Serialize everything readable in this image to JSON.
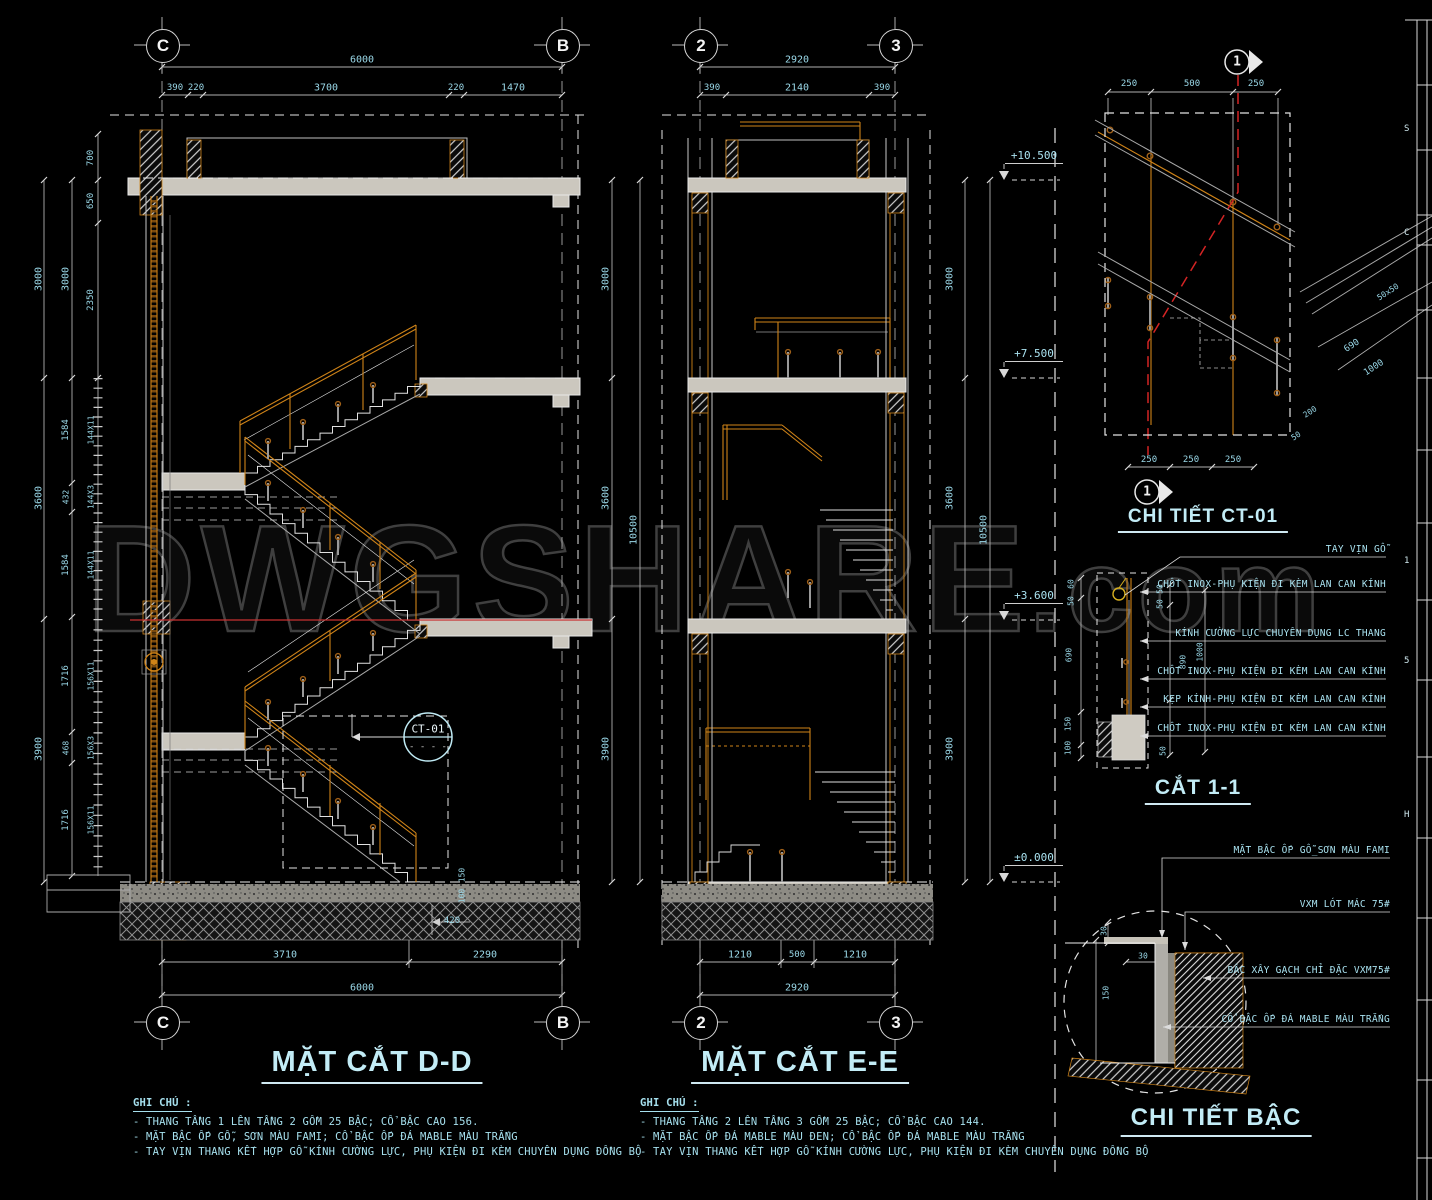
{
  "watermark": {
    "main": "DWGSHARE",
    "suffix": ".com"
  },
  "grid_bubbles": [
    "C",
    "B",
    "2",
    "3",
    "C",
    "B",
    "2",
    "3"
  ],
  "sections": {
    "dd": {
      "title": "MẶT CẮT D-D",
      "notes_heading": "GHI CHÚ :",
      "notes": [
        "- THANG TẦNG 1 LÊN TẦNG 2 GỒM 25 BẬC; CỔ BẬC CAO 156.",
        "- MẶT BẬC ỐP GỖ, SƠN MÀU FAMI; CỔ BẬC ỐP ĐÁ MABLE MÀU TRẮNG",
        "- TAY VỊN THANG KẾT HỢP GỖ KÍNH CƯỜNG LỰC, PHỤ KIỆN ĐI KÈM CHUYÊN DỤNG ĐỒNG BỘ"
      ]
    },
    "ee": {
      "title": "MẶT CẮT E-E",
      "notes_heading": "GHI CHÚ :",
      "notes": [
        "- THANG TẦNG 2 LÊN TẦNG 3 GỒM 25 BẬC; CỔ BẬC CAO 144.",
        "- MẶT BẬC ỐP ĐÁ MABLE MÀU ĐEN; CỔ BẬC ỐP ĐÁ MABLE MÀU TRẮNG",
        "- TAY VỊN THANG KẾT HỢP GỖ KÍNH CƯỜNG LỰC, PHỤ KIỆN ĐI KÈM CHUYÊN DỤNG ĐỒNG BỘ"
      ]
    },
    "ct01": {
      "title": "CHI TIẾT CT-01",
      "marker": "1"
    },
    "cat11": {
      "title": "CẮT 1-1",
      "labels": [
        "TAY VỊN GỖ",
        "CHỐT INOX-PHỤ KIỆN ĐI KÈM LAN CAN KÍNH",
        "KÍNH CƯỜNG LỰC CHUYÊN DỤNG LC THANG",
        "CHỐT INOX-PHỤ KIỆN ĐI KÈM LAN CAN KÍNH",
        "KẸP KÍNH-PHỤ KIỆN ĐI KÈM LAN CAN KÍNH",
        "CHỐT INOX-PHỤ KIỆN ĐI KÈM LAN CAN KÍNH"
      ]
    },
    "bac": {
      "title": "CHI TIẾT BẬC",
      "labels": [
        "MẶT BẬC ỐP GỖ_SƠN MÀU FAMI",
        "VXM LÓT MÁC 75#",
        "BẬC XÂY GẠCH CHỈ ĐẶC VXM75#",
        "CỔ BẬC ỐP ĐÁ MABLE MÀU TRẮNG"
      ]
    }
  },
  "callout": {
    "label": "CT-01",
    "dash": "- - - -"
  },
  "elevations": [
    "+10.500",
    "+7.500",
    "+3.600",
    "±0.000"
  ],
  "colors": {
    "dim_text": "#9ad8e8",
    "wood": "#cf8318",
    "section_red": "#d42424",
    "line": "#c8c8c8"
  },
  "titleblock_fragments": [
    {
      "t": "S",
      "y": 124
    },
    {
      "t": "C",
      "y": 228
    },
    {
      "t": "1",
      "y": 556
    },
    {
      "t": "5",
      "y": 656
    },
    {
      "t": "H",
      "y": 810
    }
  ],
  "dim_labels": [
    {
      "t": "6000",
      "x": 362,
      "y": 60,
      "r": 0
    },
    {
      "t": "390",
      "x": 175,
      "y": 88,
      "r": 0,
      "s": 9
    },
    {
      "t": "220",
      "x": 196,
      "y": 88,
      "r": 0,
      "s": 9
    },
    {
      "t": "3700",
      "x": 326,
      "y": 88,
      "r": 0
    },
    {
      "t": "220",
      "x": 456,
      "y": 88,
      "r": 0,
      "s": 9
    },
    {
      "t": "1470",
      "x": 513,
      "y": 88,
      "r": 0
    },
    {
      "t": "700",
      "x": 91,
      "y": 158,
      "r": -90,
      "s": 9
    },
    {
      "t": "650",
      "x": 91,
      "y": 201,
      "r": -90,
      "s": 9
    },
    {
      "t": "3000",
      "x": 39,
      "y": 279,
      "r": -90
    },
    {
      "t": "3000",
      "x": 66,
      "y": 279,
      "r": -90
    },
    {
      "t": "2350",
      "x": 91,
      "y": 300,
      "r": -90,
      "s": 9
    },
    {
      "t": "3600",
      "x": 39,
      "y": 498,
      "r": -90
    },
    {
      "t": "1584",
      "x": 66,
      "y": 430,
      "r": -90,
      "s": 9
    },
    {
      "t": "144X11",
      "x": 91,
      "y": 430,
      "r": -90,
      "s": 8
    },
    {
      "t": "432",
      "x": 66,
      "y": 497,
      "r": -90,
      "s": 8
    },
    {
      "t": "144X3",
      "x": 91,
      "y": 497,
      "r": -90,
      "s": 8
    },
    {
      "t": "1584",
      "x": 66,
      "y": 565,
      "r": -90,
      "s": 9
    },
    {
      "t": "144X11",
      "x": 91,
      "y": 565,
      "r": -90,
      "s": 8
    },
    {
      "t": "3900",
      "x": 39,
      "y": 749,
      "r": -90
    },
    {
      "t": "1716",
      "x": 66,
      "y": 676,
      "r": -90,
      "s": 9
    },
    {
      "t": "156X11",
      "x": 91,
      "y": 676,
      "r": -90,
      "s": 8
    },
    {
      "t": "468",
      "x": 66,
      "y": 748,
      "r": -90,
      "s": 8
    },
    {
      "t": "156X3",
      "x": 91,
      "y": 748,
      "r": -90,
      "s": 8
    },
    {
      "t": "1716",
      "x": 66,
      "y": 820,
      "r": -90,
      "s": 9
    },
    {
      "t": "156X11",
      "x": 91,
      "y": 820,
      "r": -90,
      "s": 8
    },
    {
      "t": "3710",
      "x": 285,
      "y": 955,
      "r": 0
    },
    {
      "t": "2290",
      "x": 485,
      "y": 955,
      "r": 0
    },
    {
      "t": "6000",
      "x": 362,
      "y": 988,
      "r": 0
    },
    {
      "t": "420",
      "x": 452,
      "y": 921,
      "r": 0,
      "s": 9
    },
    {
      "t": "150",
      "x": 462,
      "y": 875,
      "r": -90,
      "s": 8
    },
    {
      "t": "100",
      "x": 462,
      "y": 896,
      "r": -90,
      "s": 8
    },
    {
      "t": "2920",
      "x": 797,
      "y": 60,
      "r": 0
    },
    {
      "t": "390",
      "x": 712,
      "y": 88,
      "r": 0,
      "s": 9
    },
    {
      "t": "2140",
      "x": 797,
      "y": 88,
      "r": 0
    },
    {
      "t": "390",
      "x": 882,
      "y": 88,
      "r": 0,
      "s": 9
    },
    {
      "t": "3000",
      "x": 606,
      "y": 279,
      "r": -90
    },
    {
      "t": "3600",
      "x": 606,
      "y": 498,
      "r": -90
    },
    {
      "t": "3900",
      "x": 606,
      "y": 749,
      "r": -90
    },
    {
      "t": "10500",
      "x": 634,
      "y": 530,
      "r": -90
    },
    {
      "t": "3000",
      "x": 950,
      "y": 279,
      "r": -90
    },
    {
      "t": "3600",
      "x": 950,
      "y": 498,
      "r": -90
    },
    {
      "t": "3900",
      "x": 950,
      "y": 749,
      "r": -90
    },
    {
      "t": "10500",
      "x": 984,
      "y": 530,
      "r": -90
    },
    {
      "t": "1210",
      "x": 740,
      "y": 955,
      "r": 0
    },
    {
      "t": "500",
      "x": 797,
      "y": 955,
      "r": 0,
      "s": 9
    },
    {
      "t": "1210",
      "x": 855,
      "y": 955,
      "r": 0
    },
    {
      "t": "2920",
      "x": 797,
      "y": 988,
      "r": 0
    },
    {
      "t": "250",
      "x": 1129,
      "y": 84,
      "r": 0,
      "s": 9
    },
    {
      "t": "500",
      "x": 1192,
      "y": 84,
      "r": 0,
      "s": 9
    },
    {
      "t": "250",
      "x": 1256,
      "y": 84,
      "r": 0,
      "s": 9
    },
    {
      "t": "250",
      "x": 1149,
      "y": 460,
      "r": 0,
      "s": 9
    },
    {
      "t": "250",
      "x": 1191,
      "y": 460,
      "r": 0,
      "s": 9
    },
    {
      "t": "250",
      "x": 1233,
      "y": 460,
      "r": 0,
      "s": 9
    },
    {
      "t": "690",
      "x": 1352,
      "y": 346,
      "r": -33,
      "s": 9
    },
    {
      "t": "1000",
      "x": 1374,
      "y": 368,
      "r": -33,
      "s": 9
    },
    {
      "t": "200",
      "x": 1310,
      "y": 412,
      "r": -33,
      "s": 8
    },
    {
      "t": "50",
      "x": 1296,
      "y": 436,
      "r": -33,
      "s": 8
    },
    {
      "t": "50x50",
      "x": 1388,
      "y": 292,
      "r": -33,
      "s": 8
    },
    {
      "t": "60",
      "x": 1071,
      "y": 584,
      "r": -90,
      "s": 8
    },
    {
      "t": "50",
      "x": 1071,
      "y": 601,
      "r": -90,
      "s": 8
    },
    {
      "t": "690",
      "x": 1069,
      "y": 655,
      "r": -90,
      "s": 8
    },
    {
      "t": "150",
      "x": 1068,
      "y": 724,
      "r": -90,
      "s": 8
    },
    {
      "t": "100",
      "x": 1068,
      "y": 748,
      "r": -90,
      "s": 8
    },
    {
      "t": "50",
      "x": 1160,
      "y": 589,
      "r": -90,
      "s": 8
    },
    {
      "t": "50",
      "x": 1160,
      "y": 604,
      "r": -90,
      "s": 8
    },
    {
      "t": "890",
      "x": 1183,
      "y": 662,
      "r": -90,
      "s": 8
    },
    {
      "t": "1000",
      "x": 1200,
      "y": 652,
      "r": -90,
      "s": 8
    },
    {
      "t": "50",
      "x": 1163,
      "y": 751,
      "r": -90,
      "s": 8
    },
    {
      "t": "30",
      "x": 1104,
      "y": 931,
      "r": -90,
      "s": 8
    },
    {
      "t": "30",
      "x": 1143,
      "y": 956,
      "r": 0,
      "s": 8
    },
    {
      "t": "150",
      "x": 1106,
      "y": 993,
      "r": -90,
      "s": 8
    }
  ]
}
